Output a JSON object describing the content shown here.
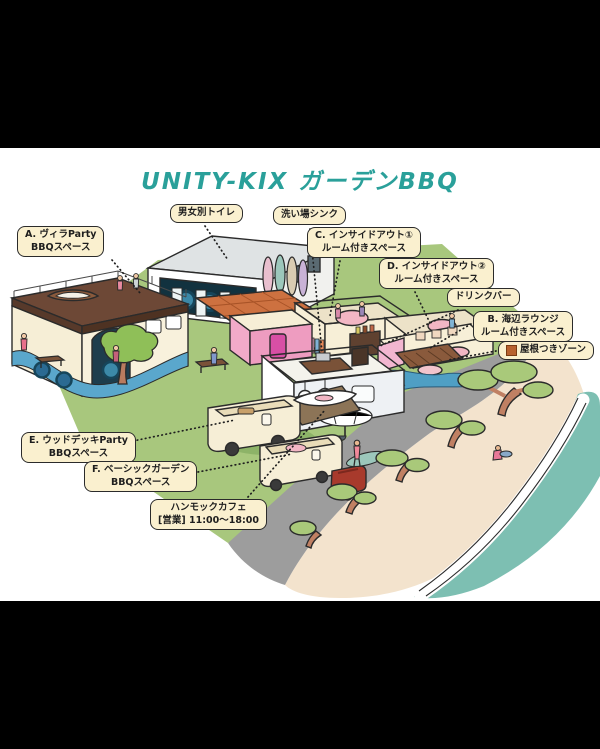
{
  "title": "UNITY-KIX ガーデンBBQ",
  "callouts": {
    "toilet": {
      "line1": "男女別トイレ"
    },
    "sink": {
      "line1": "洗い場シンク"
    },
    "villa": {
      "line1": "A. ヴィラParty",
      "line2": "BBQスペース"
    },
    "insideout1": {
      "line1": "C. インサイドアウト①",
      "line2": "ルーム付きスペース"
    },
    "insideout2": {
      "line1": "D. インサイドアウト②",
      "line2": "ルーム付きスペース"
    },
    "drinkbar": {
      "line1": "ドリンクバー"
    },
    "lounge": {
      "line1": "B. 海辺ラウンジ",
      "line2": "ルーム付きスペース"
    },
    "roofed": {
      "line1": "屋根つきゾーン"
    },
    "wooddeck": {
      "line1": "E. ウッドデッキParty",
      "line2": "BBQスペース"
    },
    "basic": {
      "line1": "F. ベーシックガーデン",
      "line2": "BBQスペース"
    },
    "hammock": {
      "line1": "ハンモックカフェ",
      "line2": "[営業] 11:00〜18:00"
    }
  },
  "colors": {
    "title_teal": "#2aa09a",
    "label_background": "#faf0cf",
    "label_border": "#2b2b2b",
    "lawn_green": "#a8c77d",
    "road_gray": "#9d9d9d",
    "sand_beige": "#f3e3cd",
    "ocean_teal": "#7dbfb2",
    "roofed_swatch_style": "background:#b8622f"
  }
}
